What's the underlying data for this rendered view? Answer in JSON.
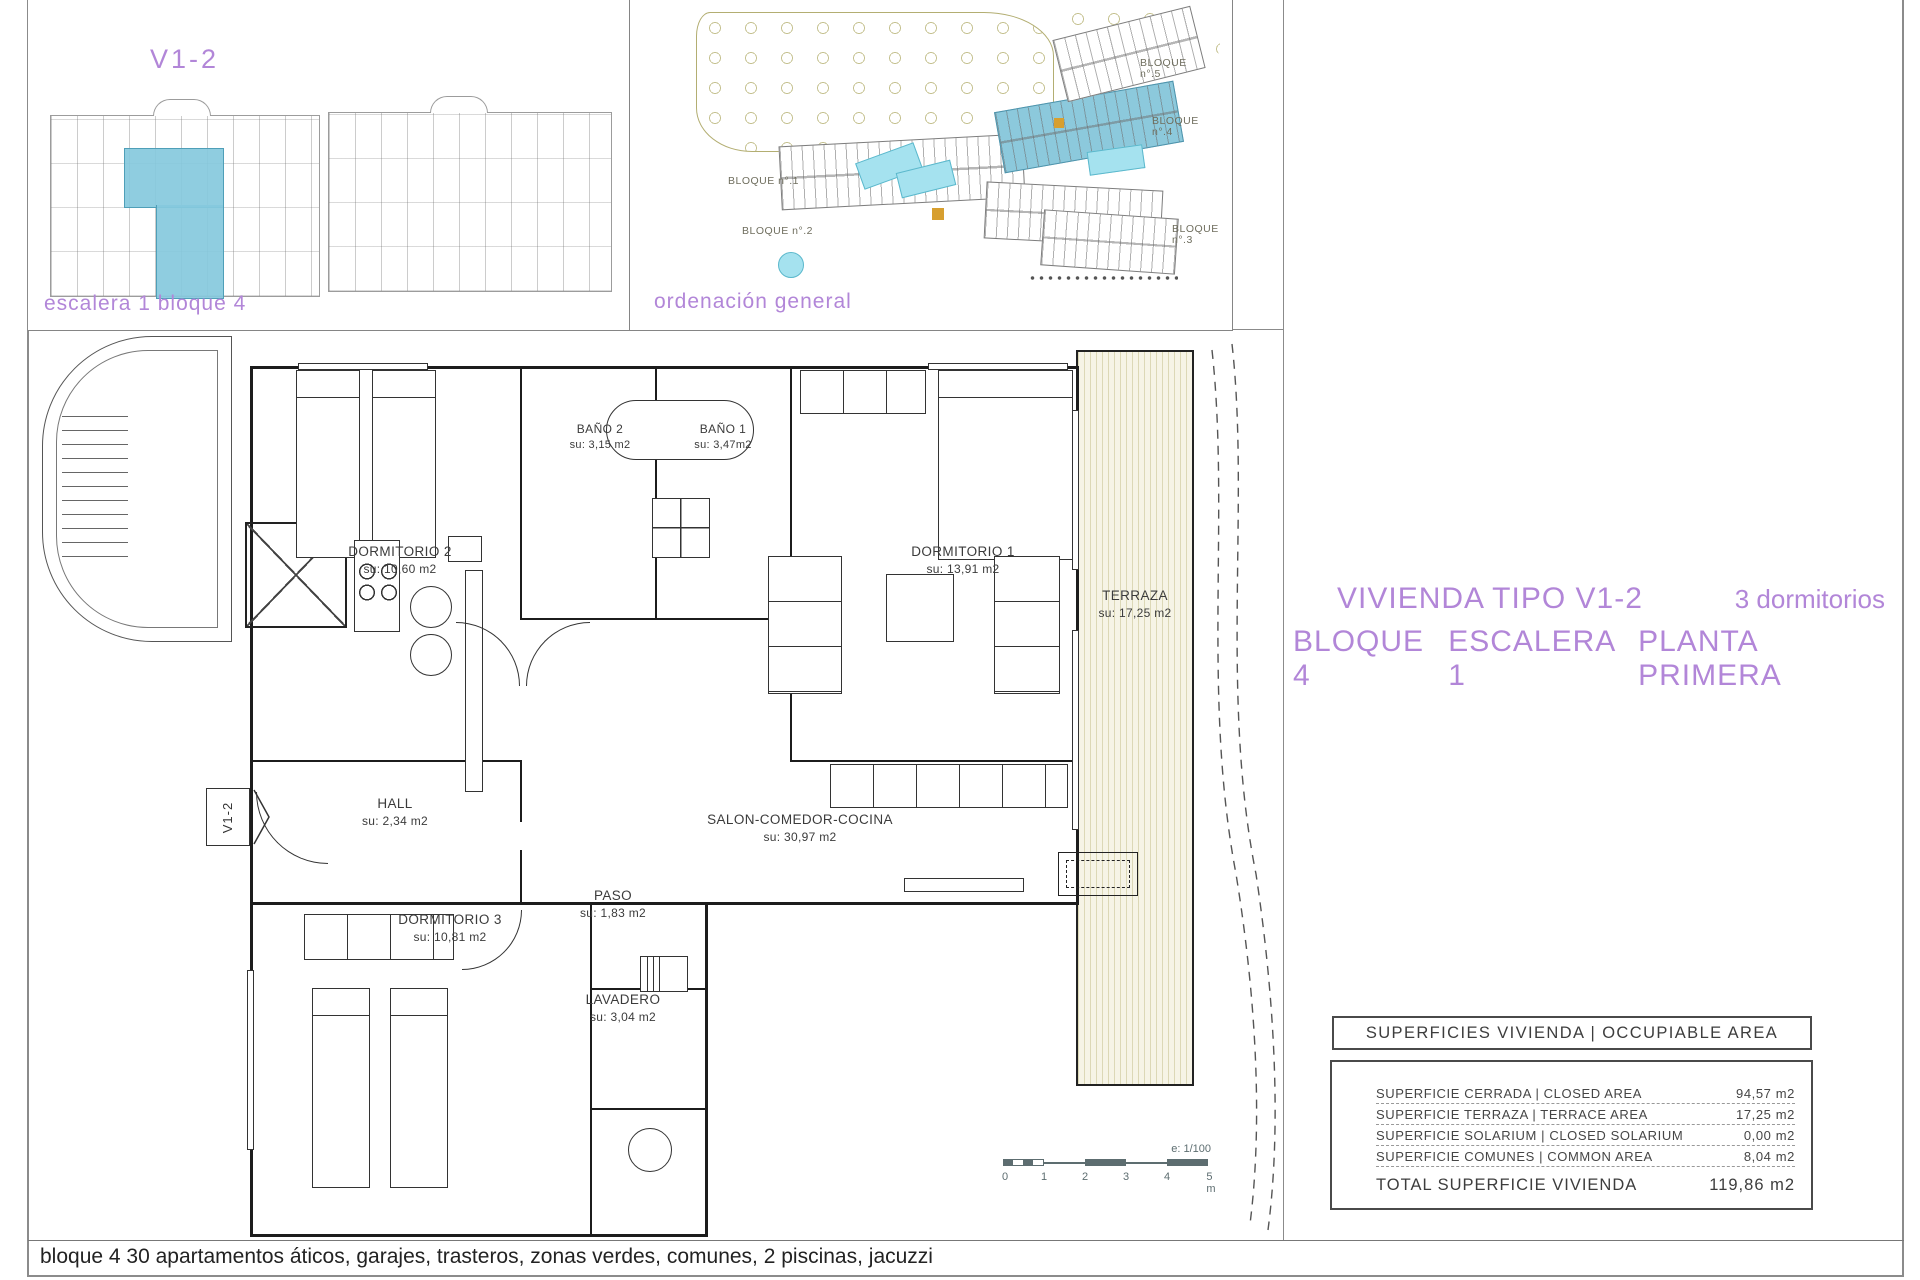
{
  "colors": {
    "accent_purple": "#b286d8",
    "highlight_blue": "#8cc9dc",
    "terrace_fill": "#f6f4e6",
    "scalebar_gray": "#5d6d70"
  },
  "panel_key": {
    "title": "V1-2",
    "caption": "escalera 1 bloque 4"
  },
  "panel_site": {
    "caption": "ordenación general",
    "bloques": [
      "BLOQUE n°.1",
      "BLOQUE n°.2",
      "BLOQUE n°.3",
      "BLOQUE n°.4",
      "BLOQUE n°.5"
    ]
  },
  "title_block": {
    "line1_left": "VIVIENDA TIPO V1-2",
    "line1_right": "3 dormitorios",
    "line2_parts": [
      "BLOQUE 4",
      "ESCALERA 1",
      "PLANTA PRIMERA"
    ]
  },
  "floor_plan": {
    "marker": "V1-2",
    "rooms": {
      "d2": {
        "name": "DORMITORIO 2",
        "area": "su: 10,60 m2"
      },
      "b2": {
        "name": "BAÑO 2",
        "area": "su: 3,15 m2"
      },
      "b1": {
        "name": "BAÑO 1",
        "area": "su: 3,47m2"
      },
      "d1": {
        "name": "DORMITORIO 1",
        "area": "su: 13,91 m2"
      },
      "terraza": {
        "name": "TERRAZA",
        "area": "su: 17,25 m2"
      },
      "hall": {
        "name": "HALL",
        "area": "su: 2,34 m2"
      },
      "salon": {
        "name": "SALON-COMEDOR-COCINA",
        "area": "su: 30,97 m2"
      },
      "d3": {
        "name": "DORMITORIO 3",
        "area": "su: 10,81 m2"
      },
      "paso": {
        "name": "PASO",
        "area": "su: 1,83 m2"
      },
      "lavadero": {
        "name": "LAVADERO",
        "area": "su: 3,04 m2"
      }
    }
  },
  "scale_bar": {
    "label": "e: 1/100",
    "ticks": [
      "0",
      "1",
      "2",
      "3",
      "4",
      "5 m"
    ]
  },
  "area_table": {
    "header": "SUPERFICIES VIVIENDA | OCCUPIABLE AREA",
    "rows": [
      {
        "label": "SUPERFICIE CERRADA | CLOSED AREA",
        "value": "94,57 m2"
      },
      {
        "label": "SUPERFICIE TERRAZA  | TERRACE AREA",
        "value": "17,25 m2"
      },
      {
        "label": "SUPERFICIE SOLARIUM | CLOSED SOLARIUM",
        "value": "0,00 m2"
      },
      {
        "label": "SUPERFICIE COMUNES | COMMON AREA",
        "value": "8,04 m2"
      }
    ],
    "total_label": "TOTAL SUPERFICIE VIVIENDA",
    "total_value": "119,86 m2"
  },
  "footer": {
    "text": "bloque 4 30 apartamentos áticos, garajes, trasteros, zonas verdes, comunes, 2 piscinas, jacuzzi"
  }
}
